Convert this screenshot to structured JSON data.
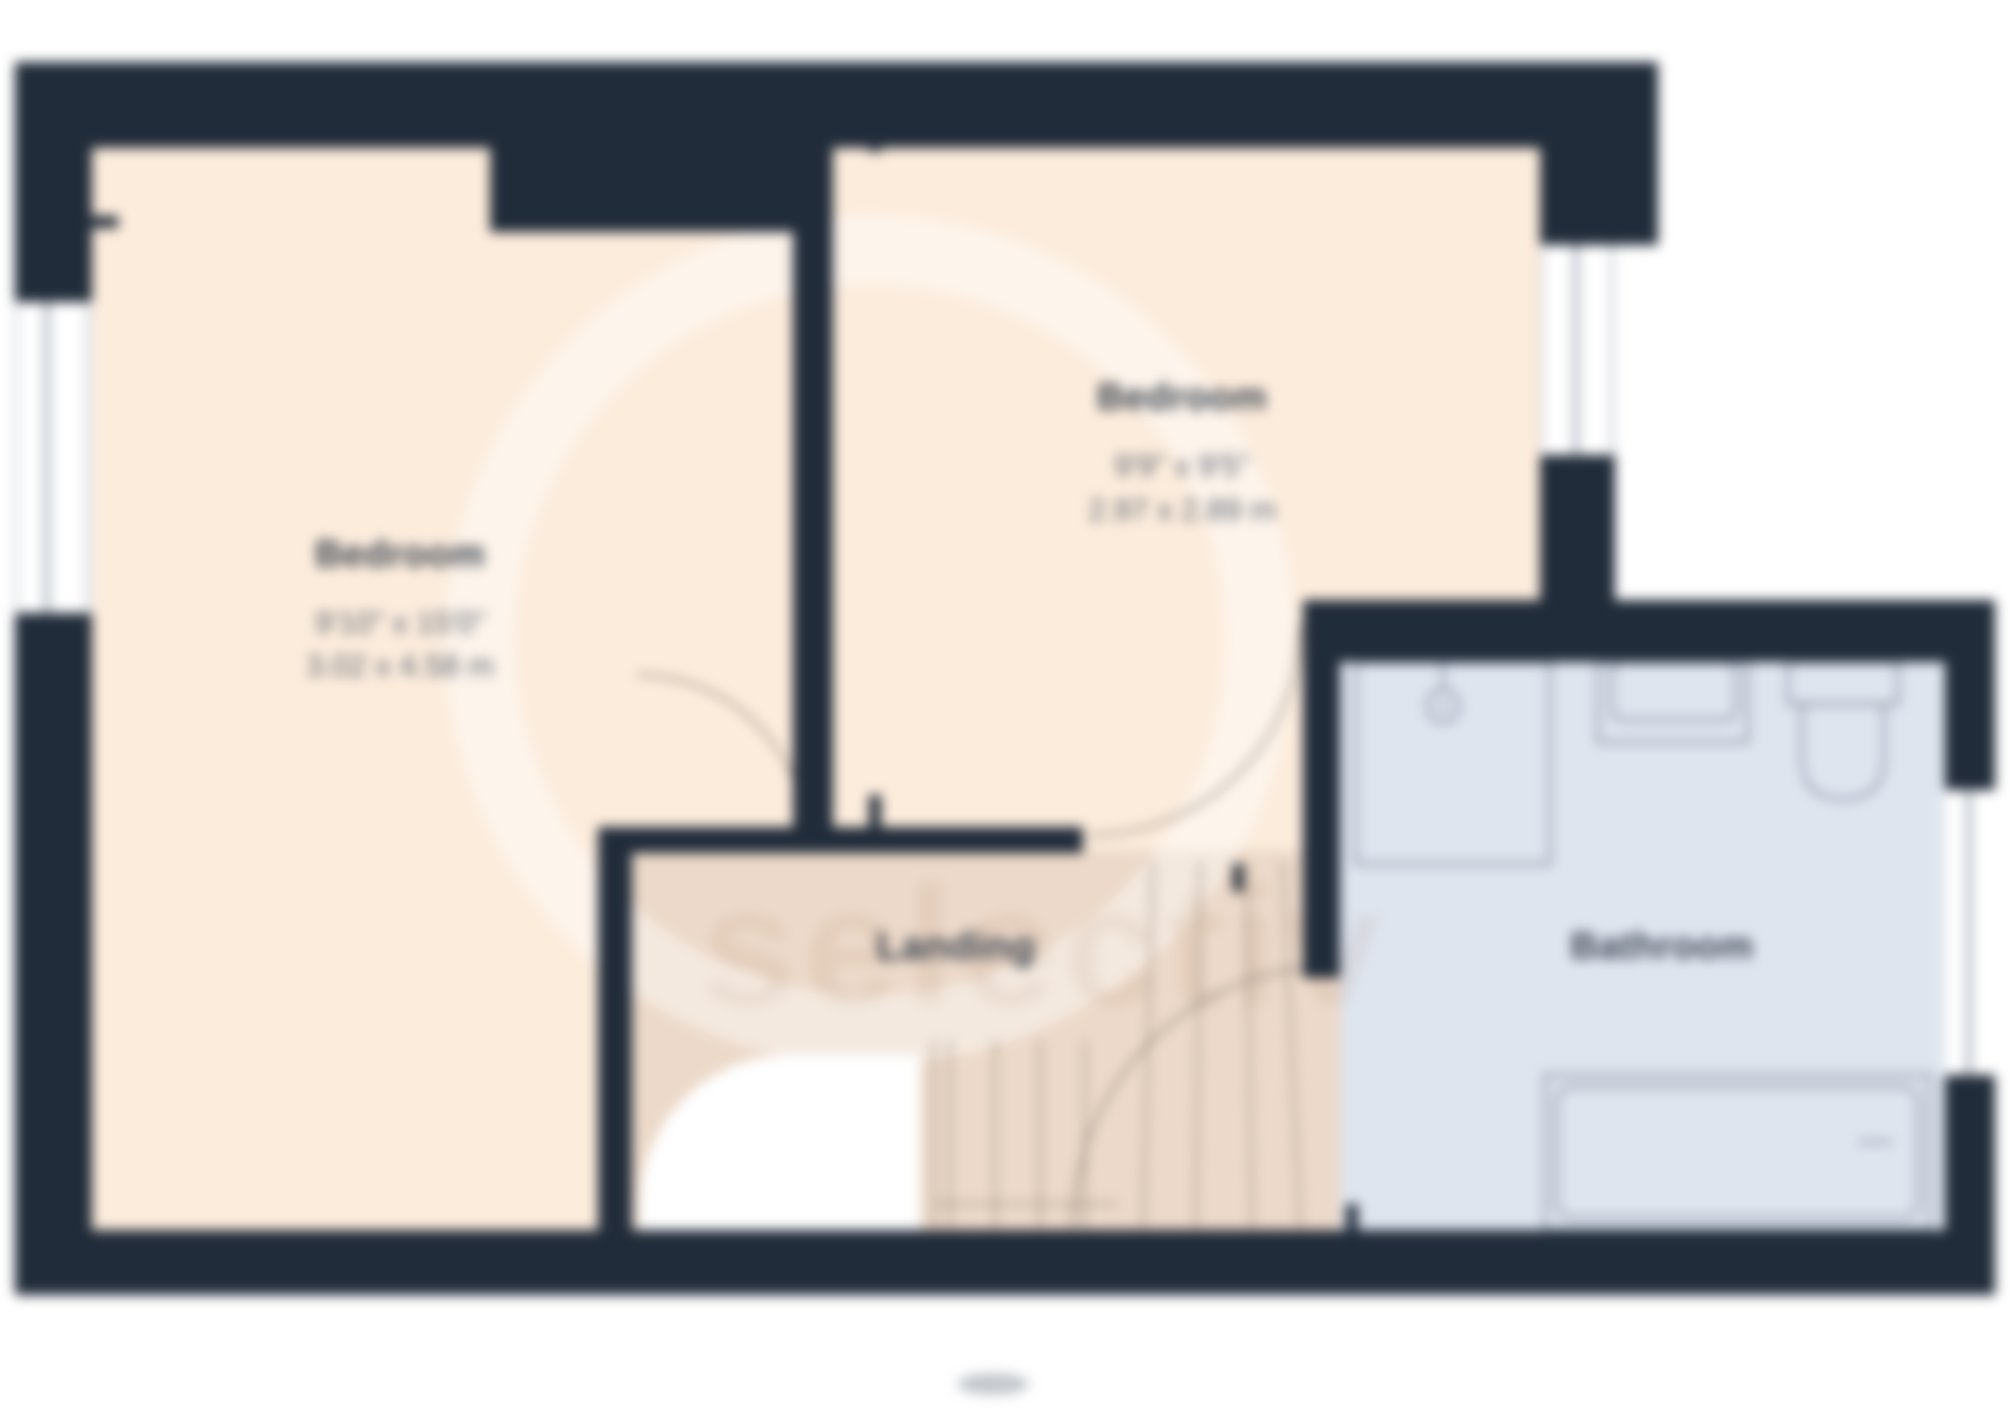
{
  "floorplan": {
    "rooms": [
      {
        "name": "Bedroom",
        "size_imperial": "9'10\" x 15'0\"",
        "size_metric": "3.02 x 4.58 m"
      },
      {
        "name": "Bedroom",
        "size_imperial": "9'9\" x 9'5\"",
        "size_metric": "2.97 x 2.89 m"
      },
      {
        "name": "Landing"
      },
      {
        "name": "Bathroom"
      }
    ],
    "fixtures": [
      "shower",
      "sink",
      "toilet",
      "bathtub",
      "staircase"
    ],
    "features": [
      "left-window",
      "right-window",
      "bathroom-window",
      "door-swings",
      "stairs-void"
    ],
    "watermark": "selectiv",
    "colors": {
      "wall": "#212c3a",
      "bedroom_floor": "#fcecdc",
      "landing_floor": "#ecd9c9",
      "bathroom_floor": "#dfe5ef",
      "fixture_line": "#707c8e",
      "door_arc": "#8b8076",
      "stair_line": "#a39587"
    }
  }
}
